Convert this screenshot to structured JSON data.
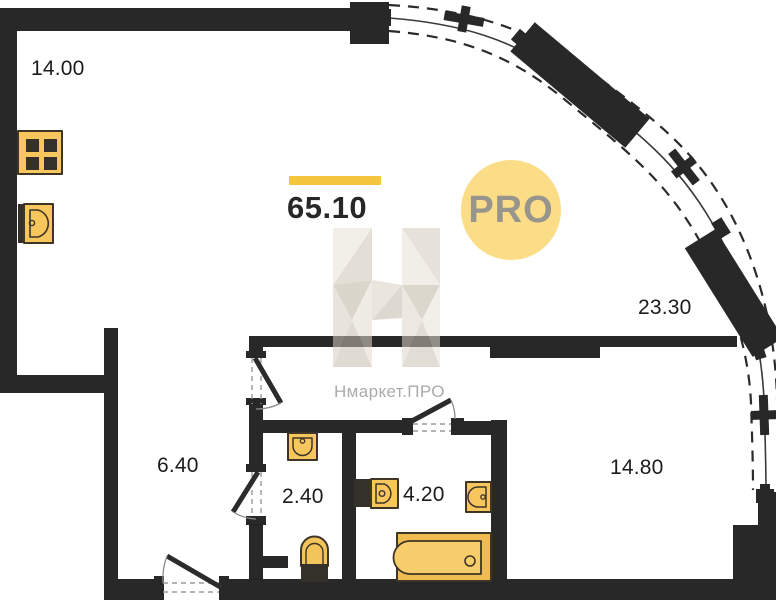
{
  "plan": {
    "total_area_label": "65.10",
    "rooms": {
      "kitchen": "14.00",
      "living": "23.30",
      "bedroom": "14.80",
      "hallway": "6.40",
      "wc": "2.40",
      "bathroom": "4.20"
    }
  },
  "watermark": {
    "title": "Нмаркет.ПРО",
    "badge_label": "PRO"
  },
  "icons": {
    "stove": "stove-icon",
    "kitchen_sink": "kitchen-sink-icon",
    "wc_sink": "wc-sink-icon",
    "toilet": "toilet-icon",
    "washing_machine": "washing-machine-icon",
    "bathroom_sink": "bathroom-sink-icon",
    "wall_sink": "wall-sink-icon",
    "bathtub": "bathtub-icon"
  },
  "colors": {
    "wall": "#282828",
    "fixture_fill": "#F7C75E",
    "fixture_outline": "#3E3526",
    "accent_bar": "#F5C540",
    "badge_bg": "#FBDC87",
    "badge_text": "#98968C",
    "watermark_gray": "#ABABAB",
    "label_text": "#1C1C1C"
  }
}
